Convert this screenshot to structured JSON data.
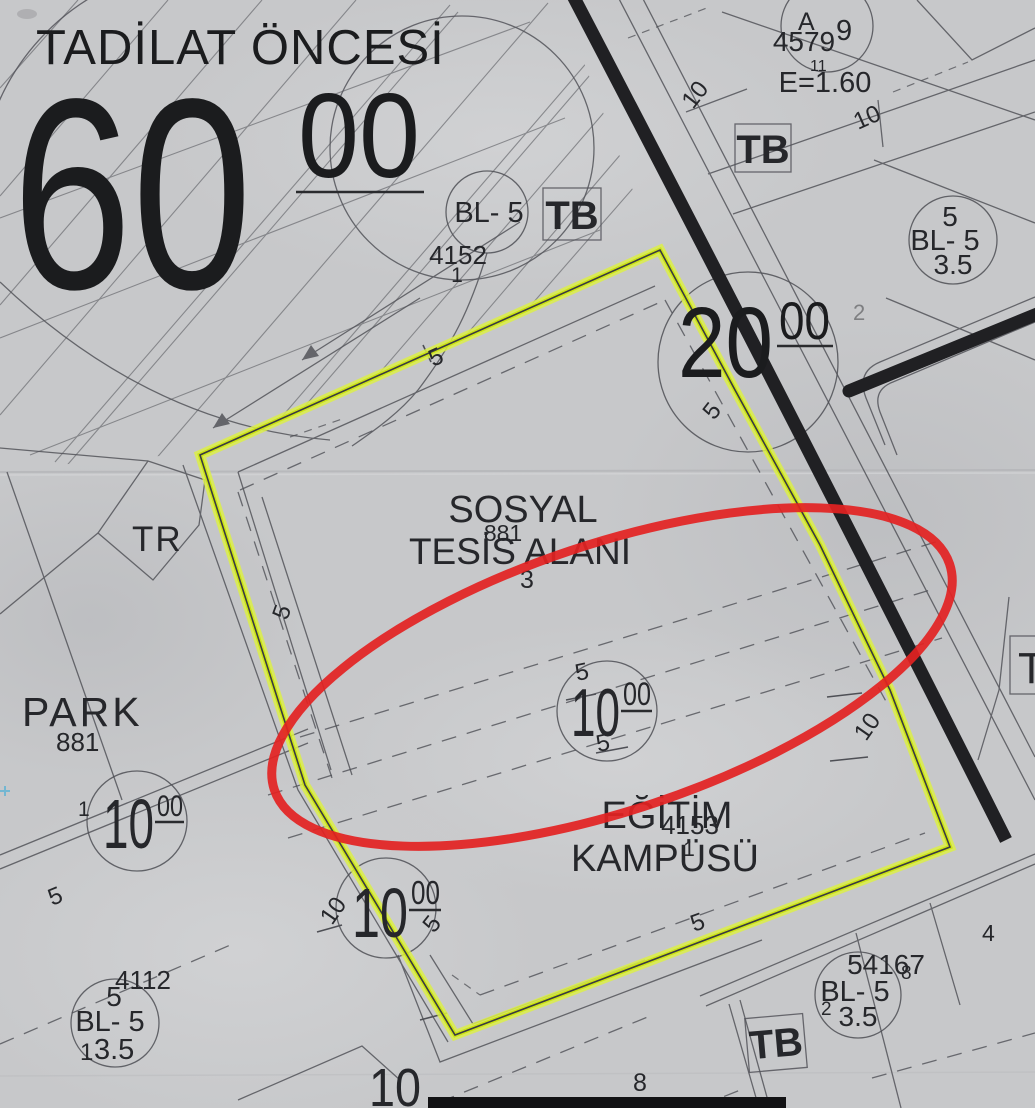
{
  "colors": {
    "paper": "#c7c8ca",
    "ink": "#26272b",
    "line": "#53545a",
    "highlight_yellow": "#d8eb33",
    "annotation_red": "#e32222",
    "road_black": "#1f1f21"
  },
  "header": {
    "title": "TADİLAT ÖNCESİ"
  },
  "dims": {
    "d1": "1",
    "d2": "2",
    "d3": "3",
    "d4": "4",
    "d5": "5",
    "d8": "8",
    "d9": "9",
    "d10": "10",
    "d11": "11",
    "d20": "20",
    "d60": "60",
    "sup": "00"
  },
  "labels": {
    "sosyal_1": "SOSYAL",
    "sosyal_2": "TESİS ALANI",
    "egitim_1": "EĞİTİM",
    "egitim_2": "KAMPÜSÜ",
    "park": "PARK",
    "tr": "TR",
    "tb": "TB",
    "t_edge": "T",
    "bl5": "BL- 5",
    "height_35": "3.5",
    "a": "A",
    "e_value": "E=1.60"
  },
  "parcels": {
    "p881": "881",
    "p4152": "4152",
    "p4153": "4153",
    "p4112": "4112",
    "p4579": "4579",
    "p54167": "54167"
  }
}
